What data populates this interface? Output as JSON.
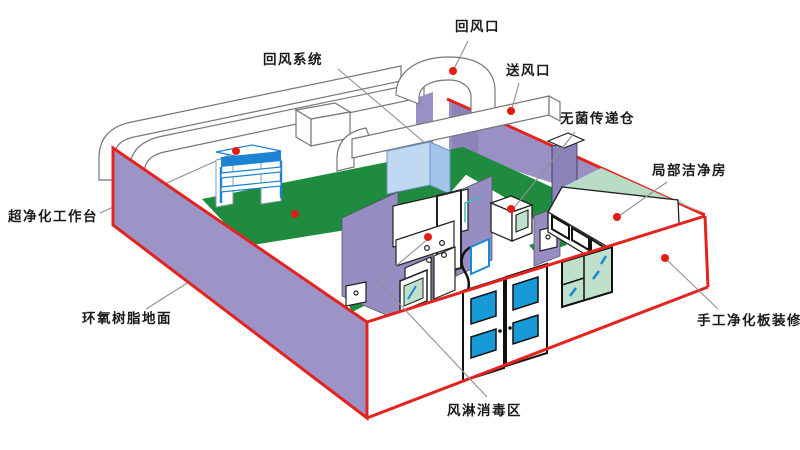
{
  "diagram": {
    "type": "cleanroom-isometric-cutaway",
    "labels": {
      "return_air_system": "回风系统",
      "return_air_outlet": "回风口",
      "supply_air_outlet": "送风口",
      "sterile_transfer_chamber": "无菌传递仓",
      "local_cleanroom": "局部洁净房",
      "ultra_clean_workbench": "超净化工作台",
      "epoxy_resin_floor": "环氧树脂地面",
      "manual_cleanroom_panel_finish": "手工净化板装修",
      "air_shower_disinfection_area": "风淋消毒区"
    },
    "colors": {
      "wall_purple": "#9c93c6",
      "interior_purple": "#978dc2",
      "dark_purple": "#8d83bb",
      "edge_red": "#e42320",
      "anchor_dot_red": "#e41d14",
      "floor_green": "#1f8b3e",
      "mint_wall": "#b9dcc6",
      "glass_green": "#bfe0cb",
      "accent_blue": "#1b87d6",
      "door_pane_blue": "#189ad8",
      "ahu_box_blue": "#c1d8f2",
      "duct_outline_gray": "#777777",
      "leader_line_gray": "#909090",
      "text_black": "#1a1a1a",
      "background": "#ffffff"
    }
  }
}
